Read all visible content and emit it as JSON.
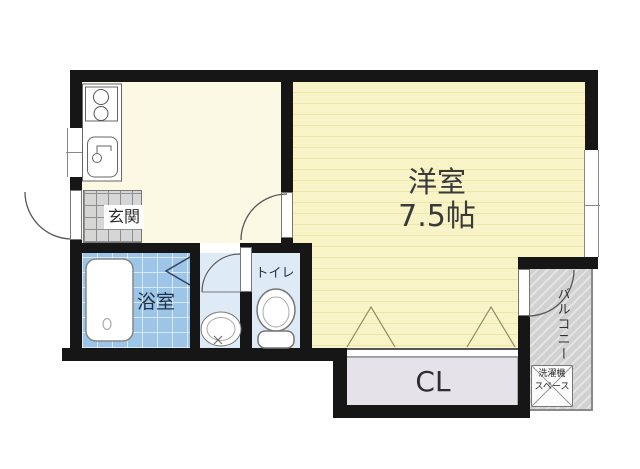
{
  "rooms": {
    "main_room": {
      "label": "洋室",
      "size": "7.5帖"
    },
    "entrance": {
      "label": "玄関"
    },
    "bathroom": {
      "label": "浴室"
    },
    "toilet": {
      "label": "トイレ"
    },
    "closet": {
      "label": "CL"
    },
    "balcony": {
      "label": "バルコニー"
    },
    "washer_space": {
      "line1": "洗濯機",
      "line2": "スペース"
    }
  },
  "colors": {
    "wall": "#161616",
    "main_room_floor": "#F9F4C7",
    "main_room_stripe": "#EDE6AB",
    "hall_floor": "#FBF8E4",
    "entrance_tile": "#D6D6D6",
    "bath_tile": "#9DC5E7",
    "sanitary_floor": "#DEEBF6",
    "closet_floor": "#E5E2EA",
    "balcony_floor": "#D1D1D1",
    "label_text": "#333333",
    "wet_area_text": "#1F2F48"
  },
  "fixtures": [
    "stove-icon",
    "kitchen-sink-icon",
    "bathtub-icon",
    "bath-folding-door-icon",
    "washbasin-icon",
    "toilet-icon",
    "door-swing-arc-icon",
    "closet-folding-door-triangle-icon",
    "window-icon",
    "washing-machine-space-icon"
  ]
}
